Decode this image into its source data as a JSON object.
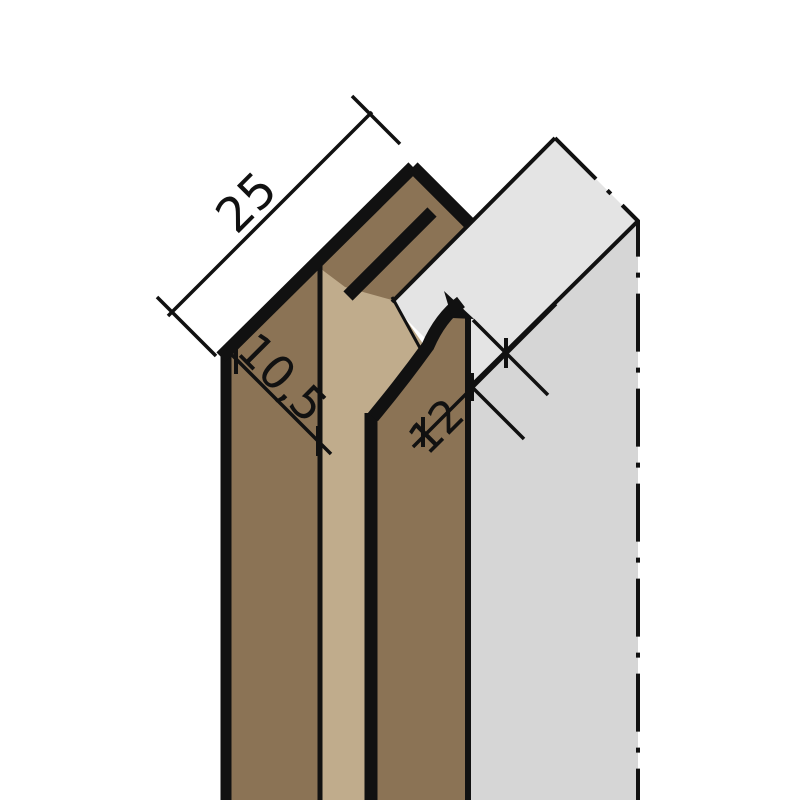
{
  "drawing": {
    "labels": {
      "flange_width": "25",
      "groove_depth": "10,5",
      "slot_depth": "12"
    },
    "colors": {
      "profile_dark": "#8b7355",
      "profile_light": "#c0ac8c",
      "panel_top": "#e4e4e4",
      "panel_front": "#d6d6d6",
      "line": "#111111",
      "background": "#ffffff"
    }
  }
}
